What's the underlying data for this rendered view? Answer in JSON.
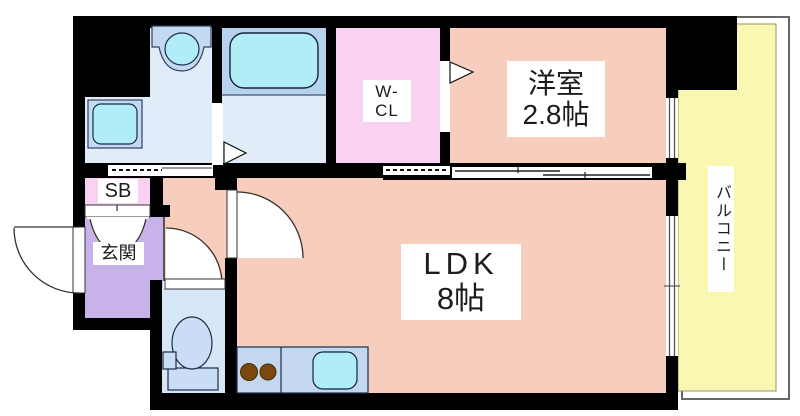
{
  "labels": {
    "western_room_name": "洋室",
    "western_room_size": "2.8帖",
    "ldk_name": "LDK",
    "ldk_size": "8帖",
    "walk_in_closet_line1": "W-",
    "walk_in_closet_line2": "CL",
    "entrance": "玄関",
    "shoe_box": "SB",
    "balcony": "バルコニー"
  },
  "colors": {
    "room_peach": "#F7CDBD",
    "closet_pink": "#FAD2F1",
    "entrance_purple": "#C7B2E9",
    "washroom_blue": "#E2ECF9",
    "bathroom_blue": "#B6D2EF",
    "water_cyan": "#B0EDF7",
    "fixture_blue": "#C4D9F2",
    "toilet_room_blue": "#D6E6F7",
    "toilet_fixture_blue": "#C9DEF5",
    "counter_blue": "#C3D8F0",
    "balcony_yellow": "#FAF7B3",
    "burner_brown": "#7B480F",
    "wall_black": "#000000",
    "line_dark": "#3A2F28"
  }
}
